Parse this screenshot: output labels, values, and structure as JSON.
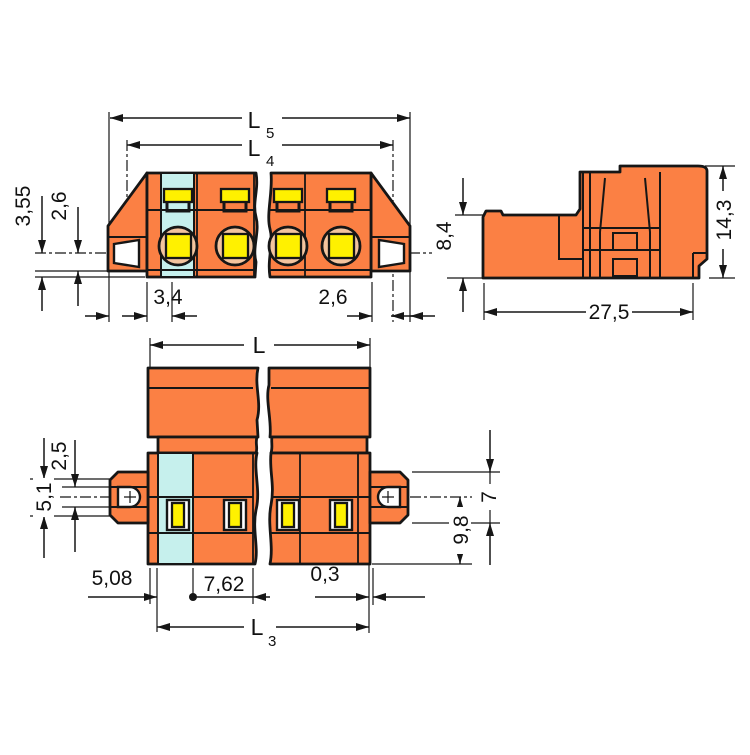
{
  "drawing": {
    "type": "technical-dimension-drawing",
    "colors": {
      "body_orange": "#FB8044",
      "coding_blue": "#C6F0ED",
      "clamp_yellow": "#FFF100",
      "funnel_peach": "#F4C49E",
      "line": "#161616",
      "background": "#FFFFFF"
    },
    "front_view": {
      "dims": {
        "l5": "L",
        "l5_sub": "5",
        "l4": "L",
        "l4_sub": "4",
        "height_355": "3,55",
        "height_26": "2,6",
        "width_34": "3,4",
        "width_26": "2,6"
      }
    },
    "side_view": {
      "dims": {
        "height_84": "8,4",
        "height_143": "14,3",
        "depth_275": "27,5"
      }
    },
    "plan_view": {
      "dims": {
        "length_l": "L",
        "offset_25": "2,5",
        "offset_51": "5,1",
        "flange_7": "7",
        "depth_98": "9,8",
        "pitch_508": "5,08",
        "pitch_762": "7,62",
        "gap_03": "0,3",
        "l3": "L",
        "l3_sub": "3"
      }
    }
  }
}
